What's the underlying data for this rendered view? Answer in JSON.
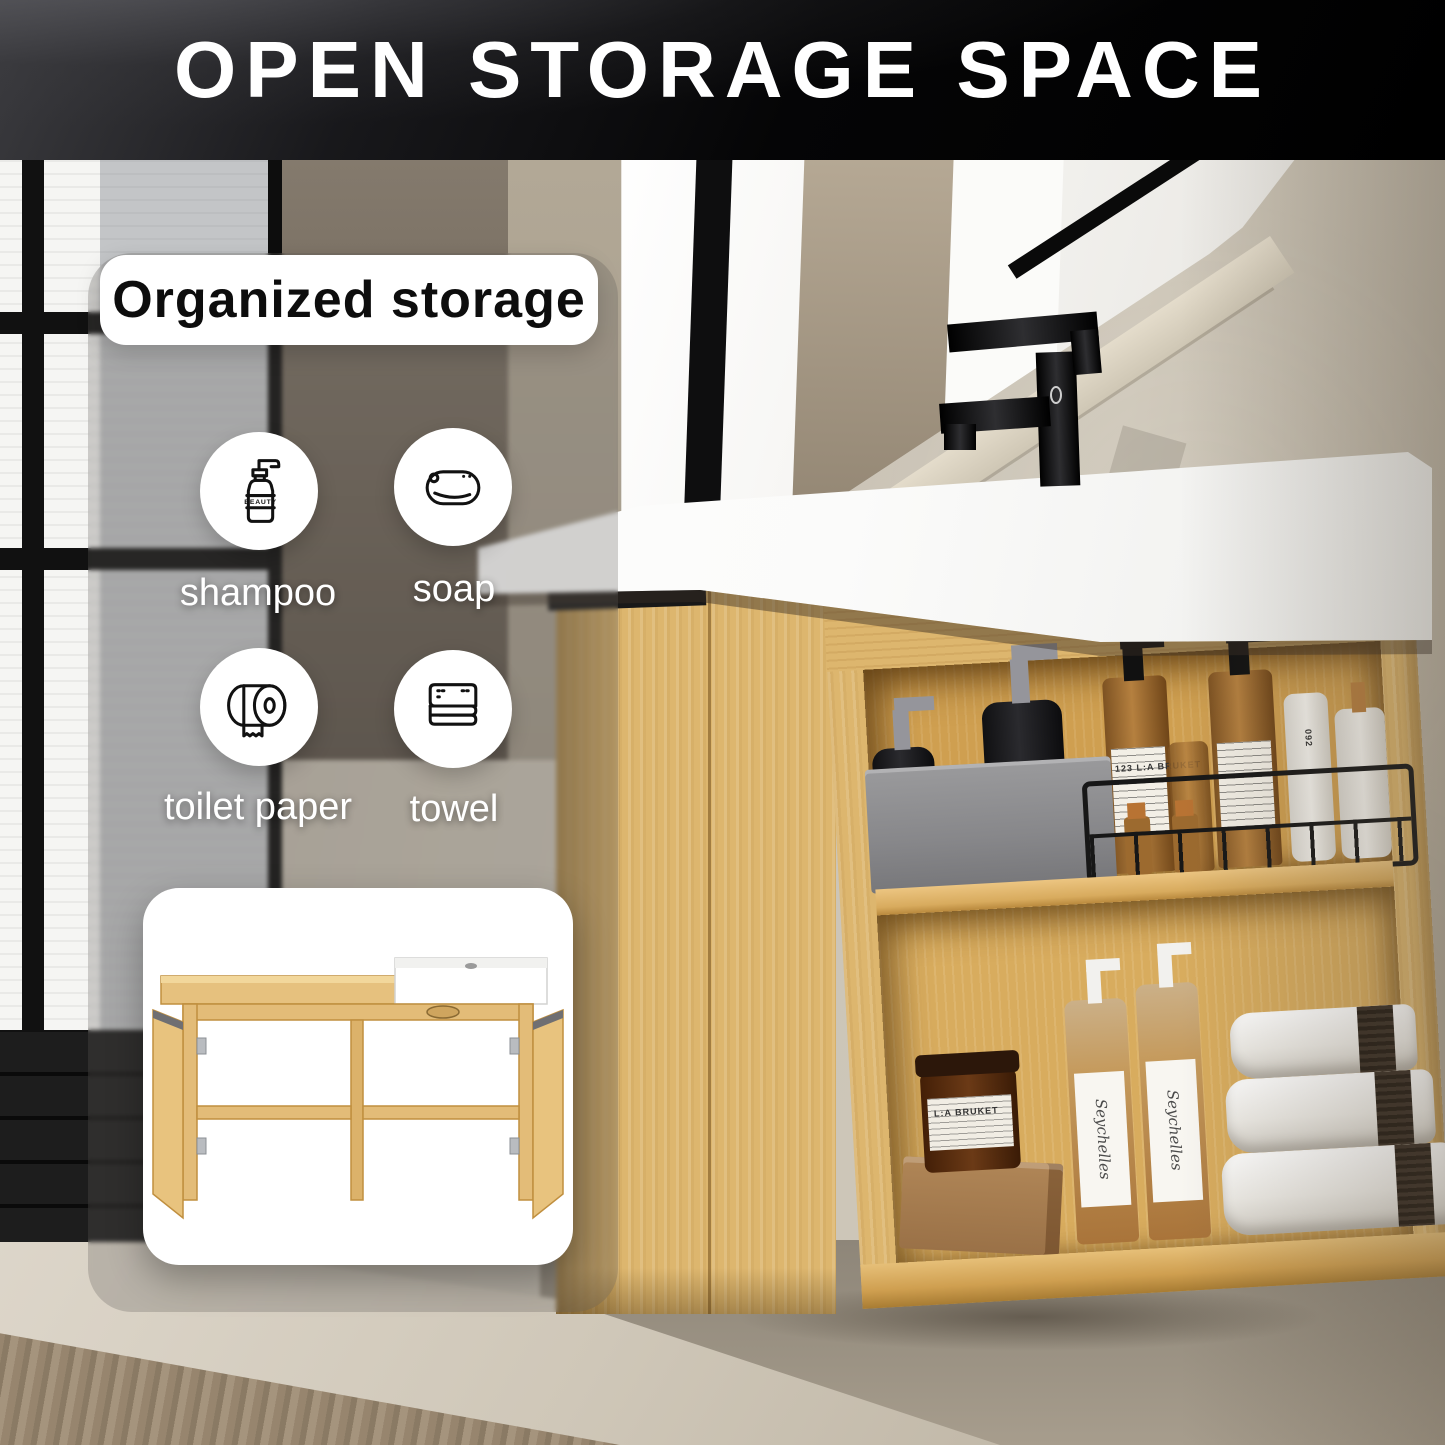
{
  "banner": {
    "title": "OPEN STORAGE SPACE",
    "bg_color": "#000000",
    "text_color": "#ffffff"
  },
  "overlay": {
    "title": "Organized storage",
    "items": [
      {
        "label": "shampoo",
        "icon": "shampoo-pump-bottle-icon",
        "icon_text": "BEAUTY"
      },
      {
        "label": "soap",
        "icon": "soap-bar-icon"
      },
      {
        "label": "toilet paper",
        "icon": "toilet-paper-roll-icon"
      },
      {
        "label": "towel",
        "icon": "folded-towel-icon"
      }
    ]
  },
  "photo": {
    "description": "wall-hung light-oak bathroom vanity with white basin, matte-black faucet, rounded mirror and two open storage shelves",
    "product_labels": {
      "jar": "L:A BRUKET",
      "soap_bottles": "Seychelles",
      "lotion_tube": "092",
      "amber_bottle": "123 L:A BRUKET"
    },
    "colors": {
      "wood": "#ddb66e",
      "wall": "#c7c0b3",
      "dark_wall": "#6e6458",
      "lower_wall": "#948c7d",
      "counter": "#f9f9f7",
      "faucet": "#111111",
      "accent_copper": "#b87333"
    }
  },
  "inset": {
    "illustration": "vanity-open-doors-front-view"
  }
}
